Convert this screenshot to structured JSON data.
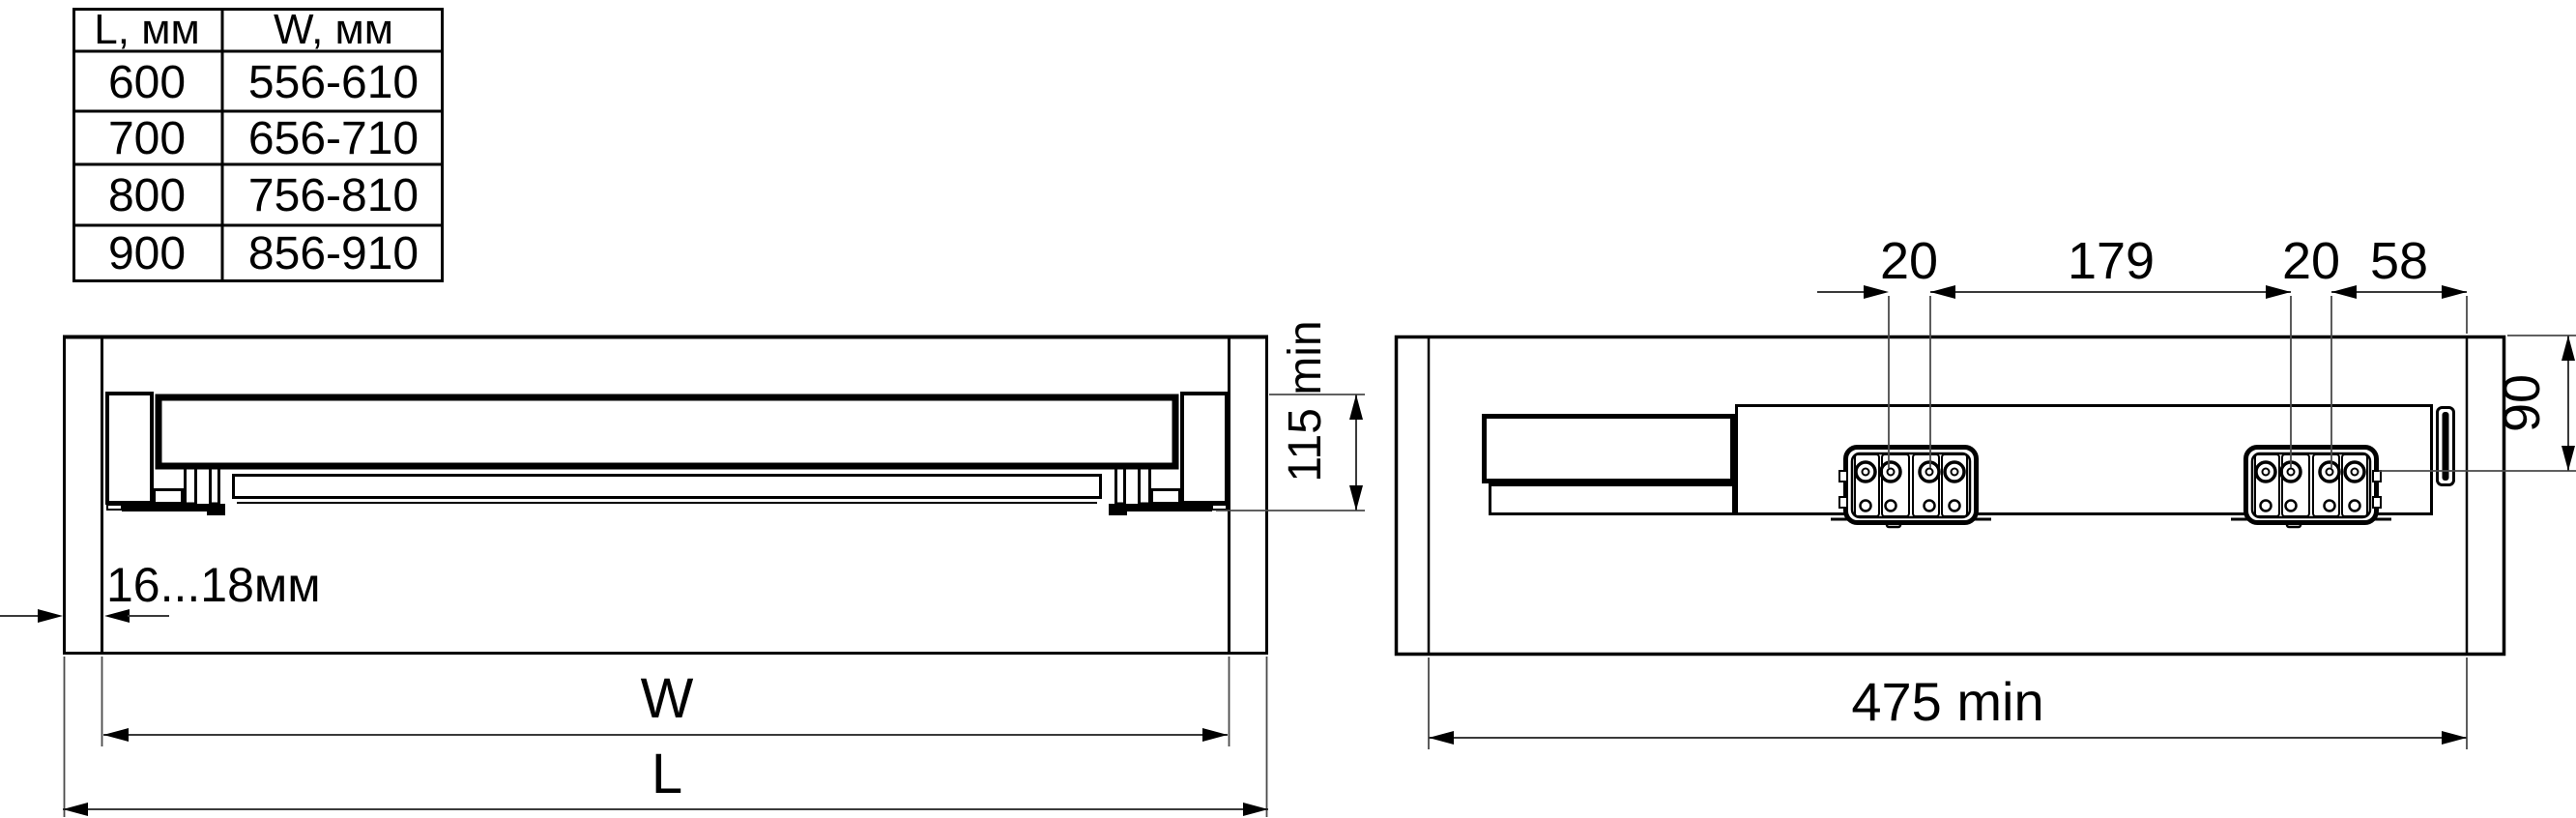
{
  "colors": {
    "line": "#000000",
    "dimension_line": "#3a3a3a",
    "background": "#ffffff"
  },
  "size_table": {
    "col_headers": [
      "L, мм",
      "W, мм"
    ],
    "rows": [
      [
        "600",
        "556-610"
      ],
      [
        "700",
        "656-710"
      ],
      [
        "800",
        "756-810"
      ],
      [
        "900",
        "856-910"
      ]
    ]
  },
  "front_view": {
    "panel_thickness": "16...18мм",
    "min_height": "115 min",
    "inner_width_label": "W",
    "outer_length_label": "L"
  },
  "side_view": {
    "front_hole_offset": "20",
    "hole_span": "179",
    "rear_hole_offset": "20",
    "front_edge_distance": "58",
    "top_distance": "90",
    "min_depth": "475 min"
  }
}
